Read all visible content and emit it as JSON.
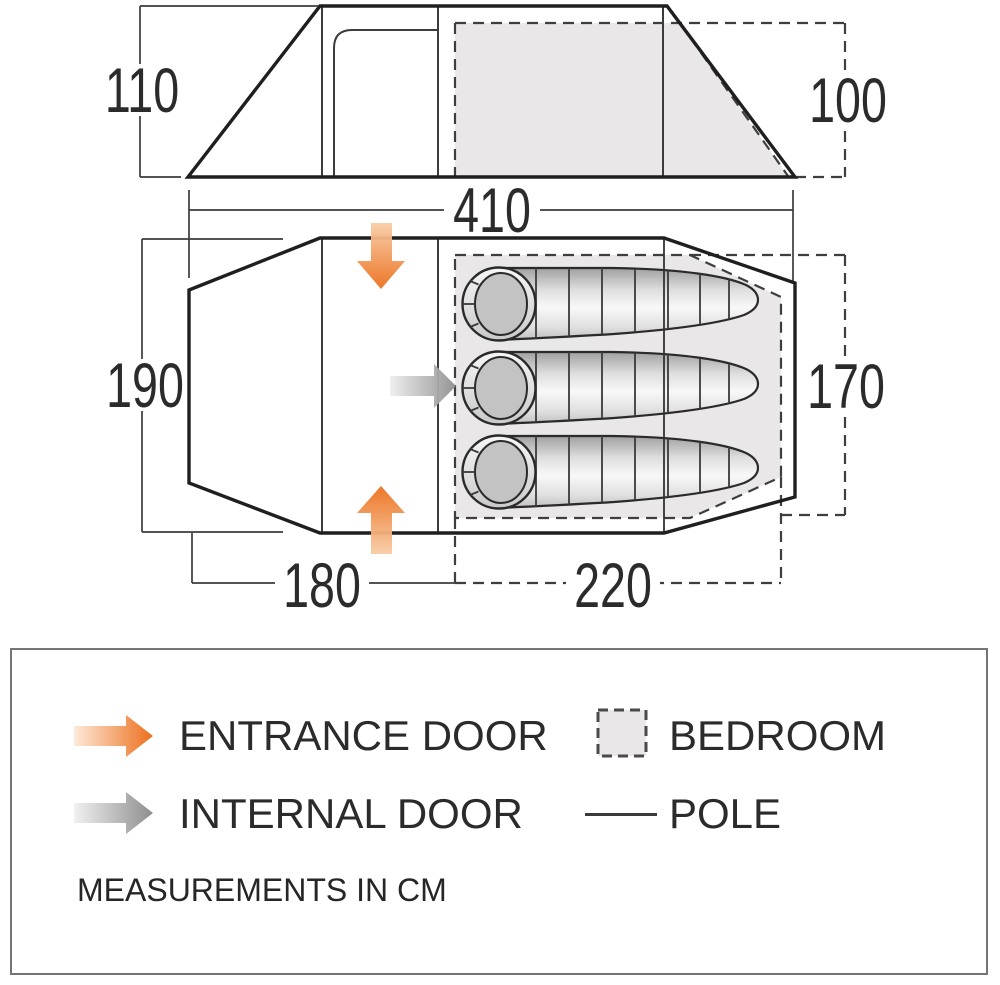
{
  "title": "Tent dimensions diagram",
  "diagram": {
    "units": "cm",
    "side_view": {
      "height_left": "110",
      "height_right": "100",
      "length": "410"
    },
    "floor_plan": {
      "width_left": "190",
      "bedroom_width": "170",
      "living_length": "180",
      "bedroom_length": "220",
      "sleeping_bag_count": 3
    }
  },
  "legend": {
    "items": [
      {
        "icon": "entrance-door-arrow-icon",
        "label": "ENTRANCE DOOR",
        "color": "#ec6f1c"
      },
      {
        "icon": "bedroom-swatch-icon",
        "label": "BEDROOM",
        "color": "#e9e7e7"
      },
      {
        "icon": "internal-door-arrow-icon",
        "label": "INTERNAL DOOR",
        "color": "#8e8e8e"
      },
      {
        "icon": "pole-line-icon",
        "label": "POLE",
        "color": "#3a3a3a"
      }
    ],
    "note": "MEASUREMENTS IN CM"
  },
  "colors": {
    "outline": "#1f1f1f",
    "bedroom_fill": "#e9e7e7",
    "entrance_orange": "#ec6f1c",
    "internal_gray": "#8e8e8e"
  }
}
